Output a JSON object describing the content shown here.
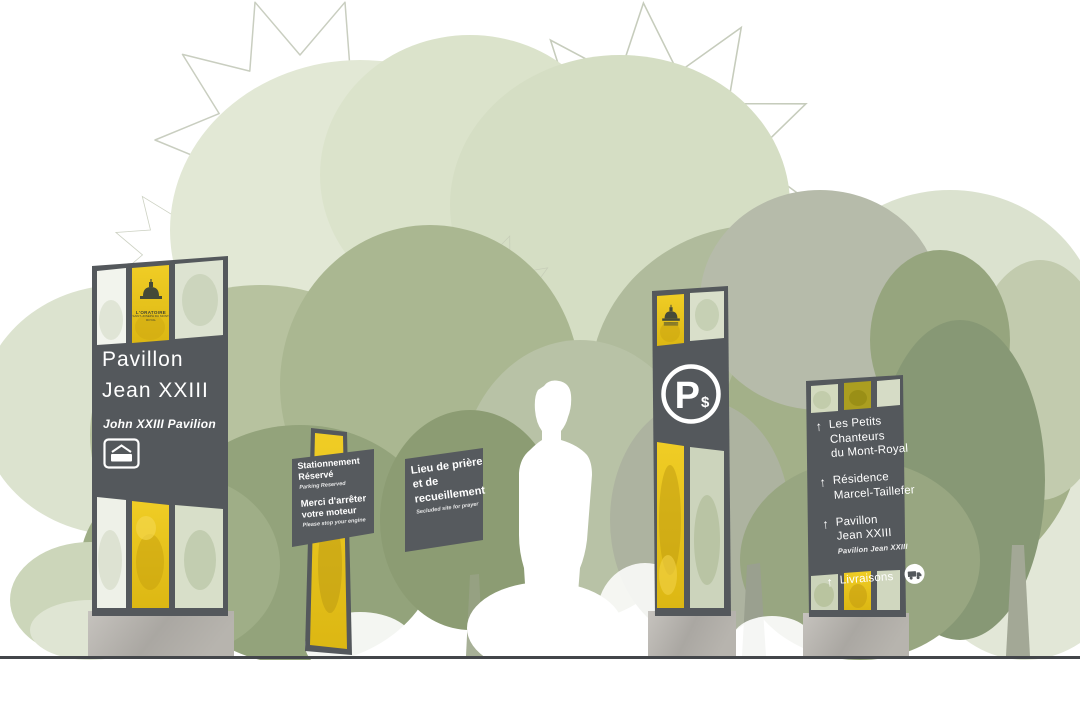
{
  "signs": {
    "pavilion_pylon": {
      "logo": {
        "title": "L'ORATOIRE",
        "subtitle": "SAINT-JOSEPH DU MONT-ROYAL",
        "icon": "oratoire-dome-icon"
      },
      "title_lines": [
        "Pavillon",
        "Jean XXIII"
      ],
      "subtitle_en": "John XXIII Pavilion",
      "icon": "bed-icon"
    },
    "parking_plaque": {
      "fr1_lines": [
        "Stationnement",
        "Réservé"
      ],
      "en1": "Parking Reserved",
      "fr2_lines": [
        "Merci d'arrêter",
        "votre moteur"
      ],
      "en2": "Please stop your engine"
    },
    "prayer_panel": {
      "fr_lines": [
        "Lieu de prière",
        "et de",
        "recueillement"
      ],
      "en": "Secluded site for prayer"
    },
    "paid_parking_pylon": {
      "letter": "P",
      "dollar": "$",
      "icon": "paid-parking-icon"
    },
    "directory_pylon": {
      "items": [
        {
          "arrow": "↑",
          "lines": [
            "Les Petits",
            "Chanteurs",
            "du Mont-Royal"
          ]
        },
        {
          "arrow": "↑",
          "lines": [
            "Résidence",
            "Marcel-Taillefer"
          ]
        },
        {
          "arrow": "↑",
          "lines": [
            "Pavillon",
            "Jean XXIII"
          ],
          "sublabel": "Pavilion Jean XXIII"
        },
        {
          "arrow": "↑",
          "lines": [
            "Livraisons"
          ],
          "icon": "delivery-truck-icon"
        }
      ]
    }
  },
  "colors": {
    "sign_dark": "#54585c",
    "sign_yellow": "#e9c51d",
    "olive_window": "#ab9e20",
    "concrete": "#b4b1ac",
    "ground_line": "#43464a",
    "tree_pale": "#dde4d0",
    "tree_sage": "#a9b78e",
    "tree_dark": "#8c9c73",
    "tree_gray_green": "#b3b8a8"
  }
}
